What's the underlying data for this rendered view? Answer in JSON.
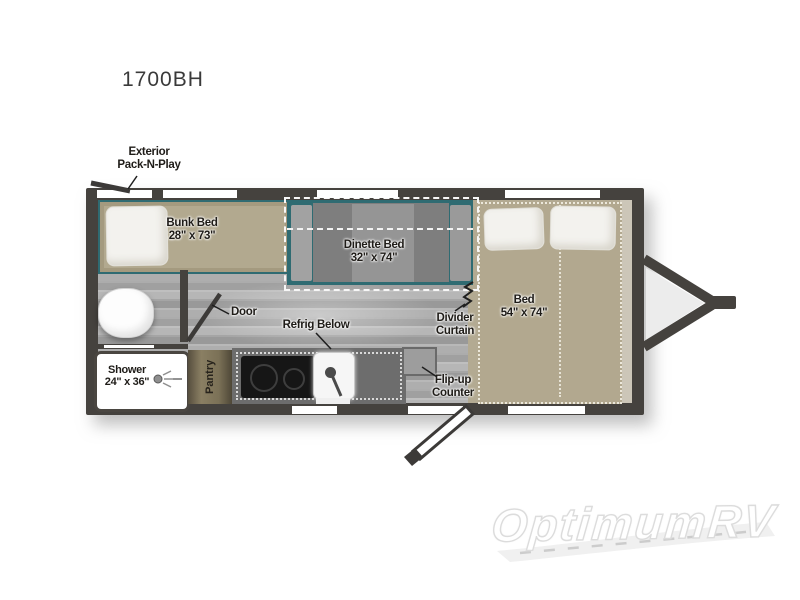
{
  "title": "1700BH",
  "plan": {
    "exterior_feature": {
      "line1": "Exterior",
      "line2": "Pack-N-Play"
    },
    "bunk_bed": {
      "name": "Bunk Bed",
      "size": "28\" x 73\""
    },
    "dinette_bed": {
      "name": "Dinette Bed",
      "size": "32\" x 74\""
    },
    "bed": {
      "name": "Bed",
      "size": "54\" x 74\""
    },
    "shower": {
      "name": "Shower",
      "size": "24\" x 36\""
    },
    "pantry": "Pantry",
    "door": "Door",
    "refrig": "Refrig Below",
    "divider_curtain": {
      "line1": "Divider",
      "line2": "Curtain"
    },
    "flip_up_counter": {
      "line1": "Flip-up",
      "line2": "Counter"
    }
  },
  "watermark": "OptimumRV",
  "colors": {
    "wall": "#45423e",
    "floor_gray": "#a6a6a6",
    "mattress_tan": "#b2a890",
    "teal_trim": "#2f6b72",
    "counter_gray": "#6d6d6d",
    "cooktop_black": "#161616",
    "pantry_brown": "#7b7157",
    "label_text": "#1f1c18",
    "watermark_gray": "#dcdcdc"
  }
}
